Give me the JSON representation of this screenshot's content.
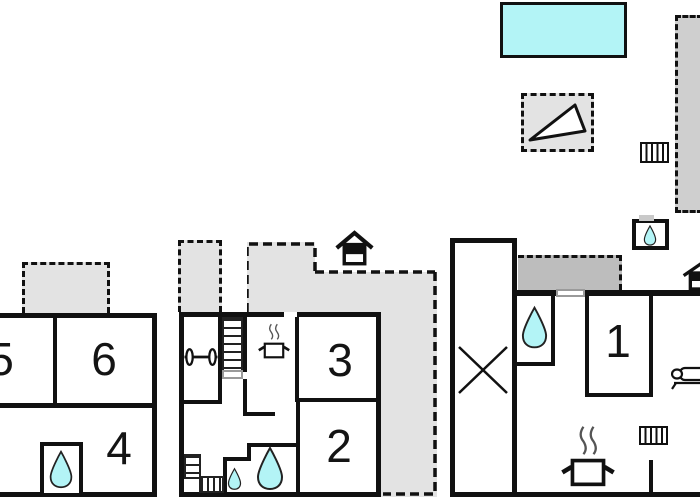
{
  "plan": {
    "type": "vacation-house-floor-plan",
    "rooms": {
      "r1": {
        "label": "1"
      },
      "r2": {
        "label": "2"
      },
      "r3": {
        "label": "3"
      },
      "r4": {
        "label": "4"
      },
      "r5": {
        "label": "5"
      },
      "r6": {
        "label": "6"
      }
    },
    "icons": {
      "pool": "swimming-pool",
      "water_drop": "water-drop",
      "cooking_pot": "cooking-pot-with-steam",
      "radiator": "radiator",
      "stairs": "stairs",
      "dumbbell": "fitness-dumbbell",
      "house": "house-entrance-marker",
      "bed": "bed",
      "cross": "cross-mark",
      "triangle": "triangle-marker"
    },
    "colors": {
      "water": "#b3f4f6",
      "terrace_light": "#e3e3e3",
      "terrace_dark": "#bdbdbd",
      "wall": "#111111",
      "background": "#ffffff"
    }
  }
}
